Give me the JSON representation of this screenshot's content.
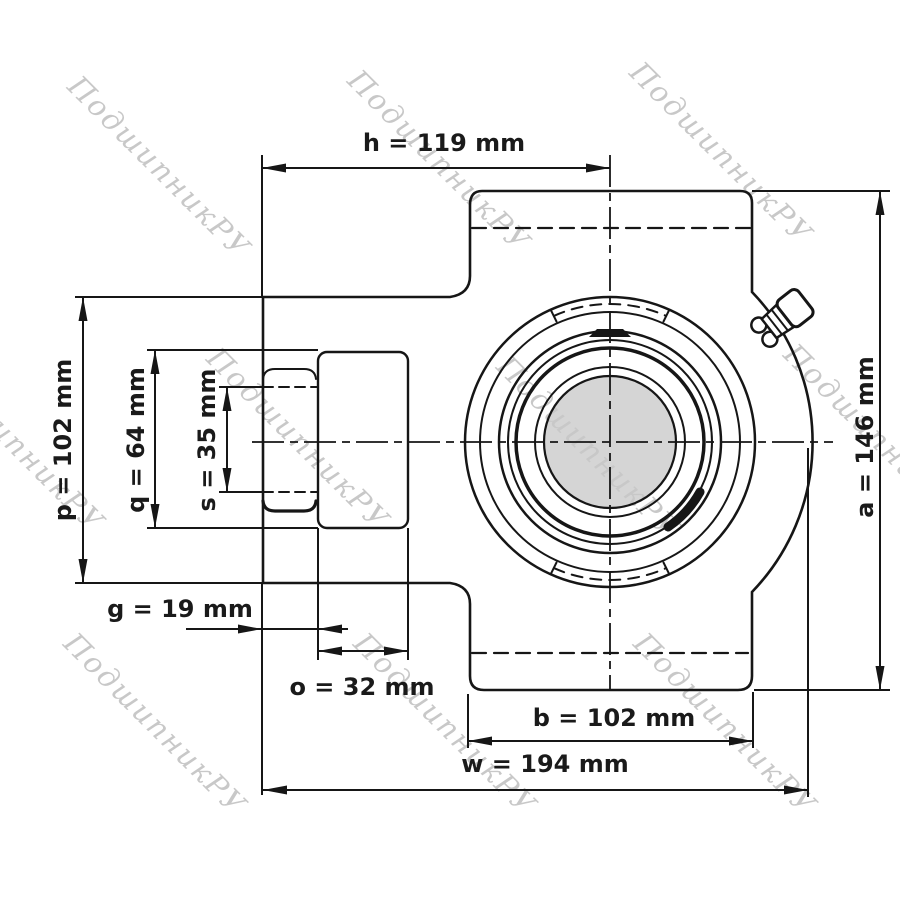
{
  "title": "Take-up bearing unit technical drawing",
  "watermark": {
    "text": "ПодшипникРУ",
    "color": "#c8c8c8"
  },
  "dimensions": {
    "h": {
      "label": "h = 119 mm",
      "value_mm": 119
    },
    "p": {
      "label": "p = 102 mm",
      "value_mm": 102
    },
    "q": {
      "label": "q = 64 mm",
      "value_mm": 64
    },
    "s": {
      "label": "s = 35 mm",
      "value_mm": 35
    },
    "g": {
      "label": "g = 19 mm",
      "value_mm": 19
    },
    "o": {
      "label": "o = 32 mm",
      "value_mm": 32
    },
    "b": {
      "label": "b = 102 mm",
      "value_mm": 102
    },
    "w": {
      "label": "w = 194 mm",
      "value_mm": 194
    },
    "a": {
      "label": "a = 146 mm",
      "value_mm": 146
    }
  },
  "colors": {
    "line": "#161616",
    "bore_fill": "#d5d5d5",
    "background": "#ffffff"
  }
}
